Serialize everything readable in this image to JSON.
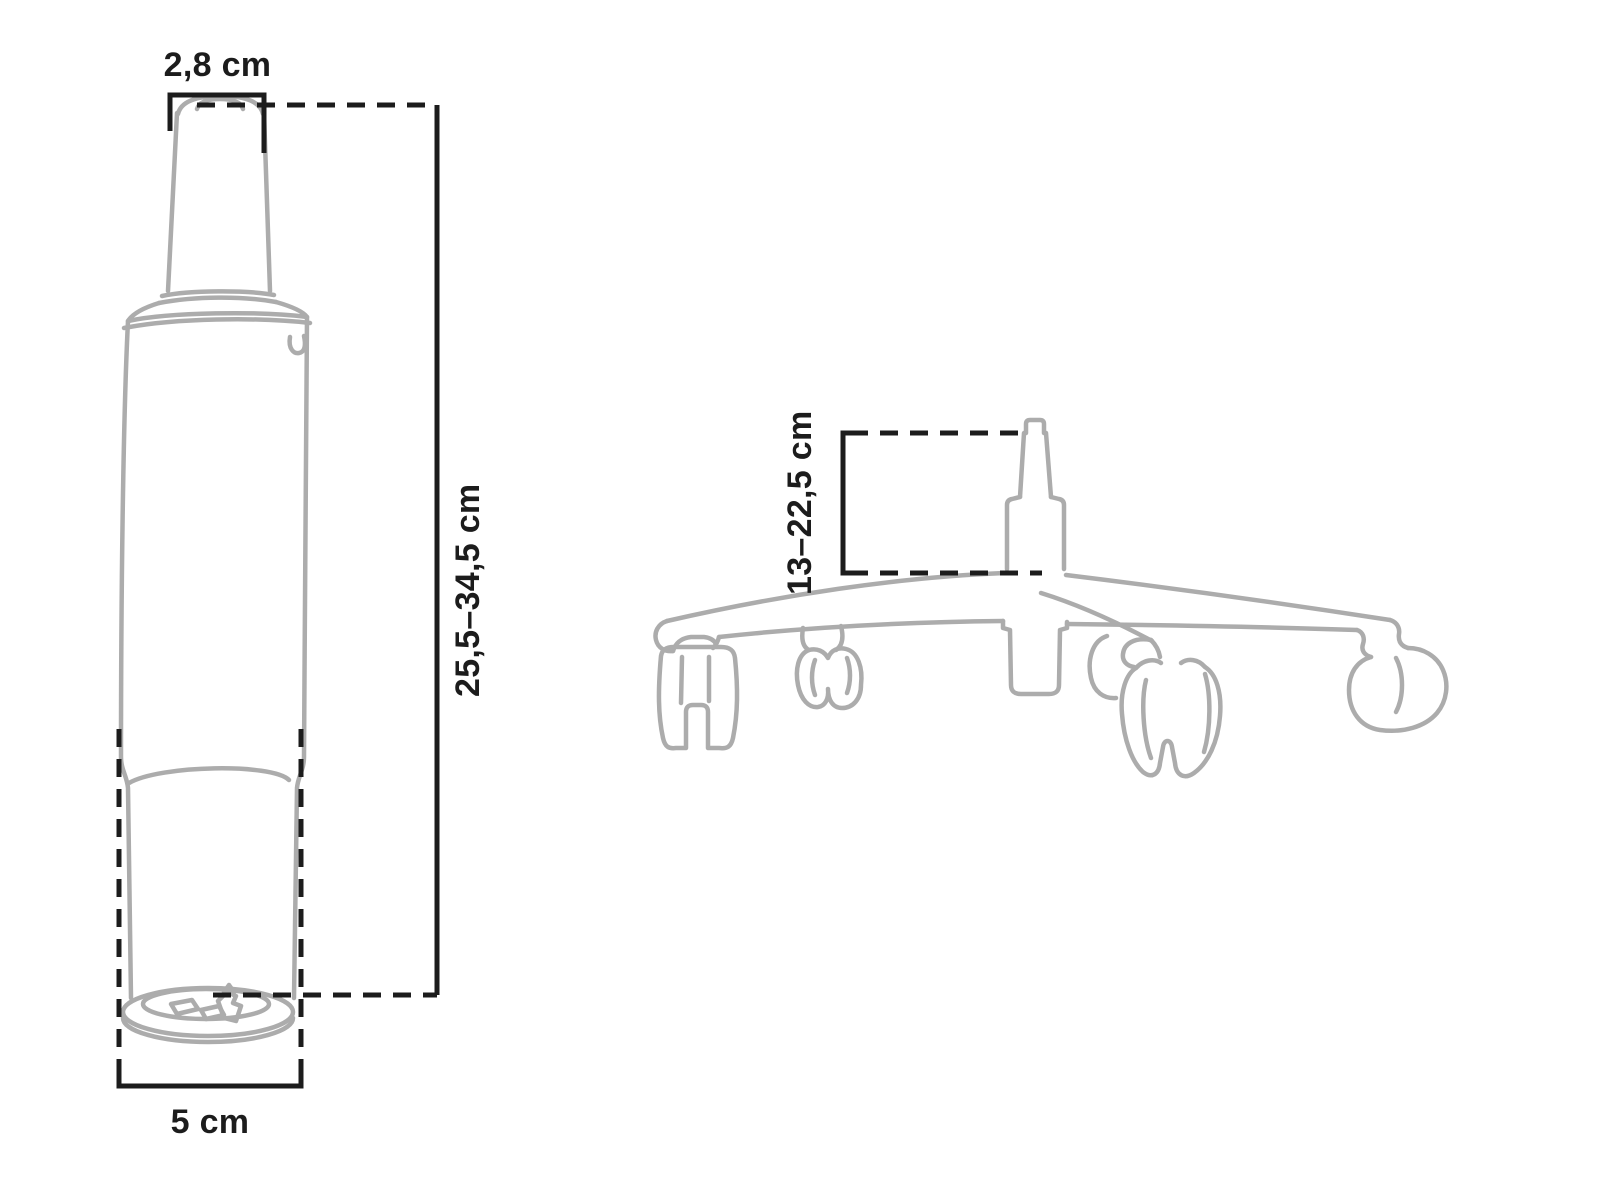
{
  "page": {
    "background_color": "#ffffff"
  },
  "colors": {
    "artwork_stroke": "#acacac",
    "dimension_stroke": "#1c1c1c",
    "label_text": "#1c1c1c"
  },
  "gas_lift_figure": {
    "labels": {
      "top_width": "2,8 cm",
      "height_range": "25,5–34,5 cm",
      "bottom_width": "5 cm"
    }
  },
  "base_figure": {
    "labels": {
      "stem_height_range": "13–22,5 cm"
    }
  }
}
